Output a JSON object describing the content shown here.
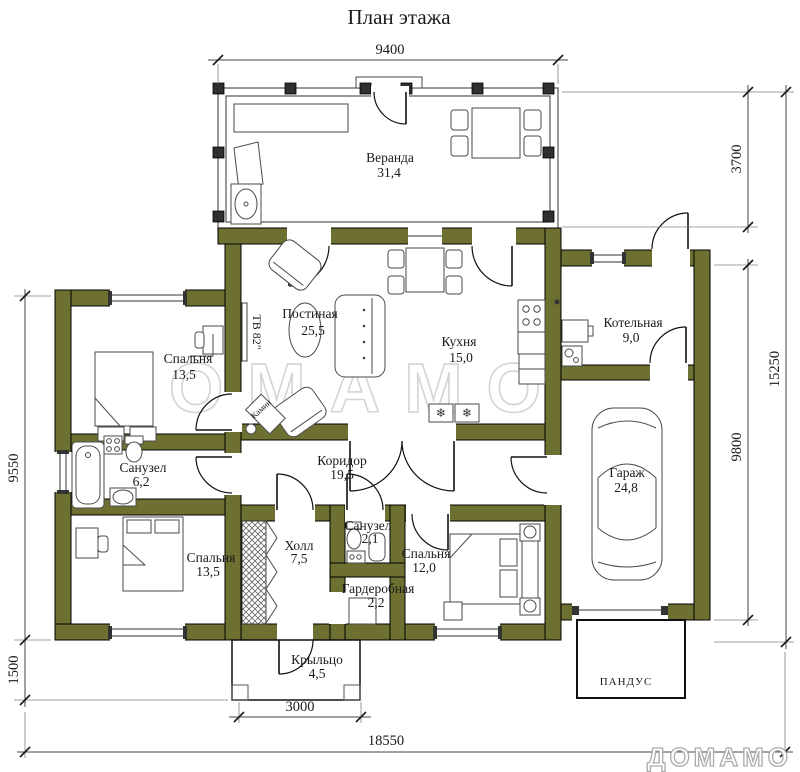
{
  "title": "План этажа",
  "watermark_text": "ДОМАМО",
  "logo_text": "ДОМАМО",
  "rooms": {
    "veranda": {
      "name": "Веранда",
      "area": "31,4"
    },
    "living": {
      "name": "Постиная",
      "area": "25,5"
    },
    "kitchen": {
      "name": "Кухня",
      "area": "15,0"
    },
    "boiler": {
      "name": "Котельная",
      "area": "9,0"
    },
    "bedroom_top": {
      "name": "Спальня",
      "area": "13,5"
    },
    "bathroom_main": {
      "name": "Санузел",
      "area": "6,2"
    },
    "corridor": {
      "name": "Коридор",
      "area": "19,5"
    },
    "garage": {
      "name": "Гараж",
      "area": "24,8"
    },
    "bedroom_bottom_left": {
      "name": "Спальня",
      "area": "13,5"
    },
    "hall": {
      "name": "Холл",
      "area": "7,5"
    },
    "bathroom_small": {
      "name": "Санузел",
      "area": "2,1"
    },
    "bedroom_bottom_right": {
      "name": "Спальня",
      "area": "12,0"
    },
    "wardrobe": {
      "name": "Гардеробная",
      "area": "2,2"
    },
    "porch": {
      "name": "Крыльцо",
      "area": "4,5"
    },
    "ramp": {
      "name": "ПАНДУС"
    }
  },
  "annotations": {
    "tv": "ТВ 82\"",
    "fireplace": "Камин"
  },
  "dimensions": {
    "top_width": "9400",
    "veranda_depth": "3700",
    "right_total_depth": "15250",
    "right_house_depth": "9800",
    "left_house_depth": "9550",
    "porch_depth": "1500",
    "porch_width": "3000",
    "total_width": "18550"
  },
  "icons": {
    "snowflake": "❄"
  },
  "colors": {
    "wall_fill": "#6d7031",
    "outline": "#1a1a1a",
    "watermark": "#d4d4d4"
  }
}
